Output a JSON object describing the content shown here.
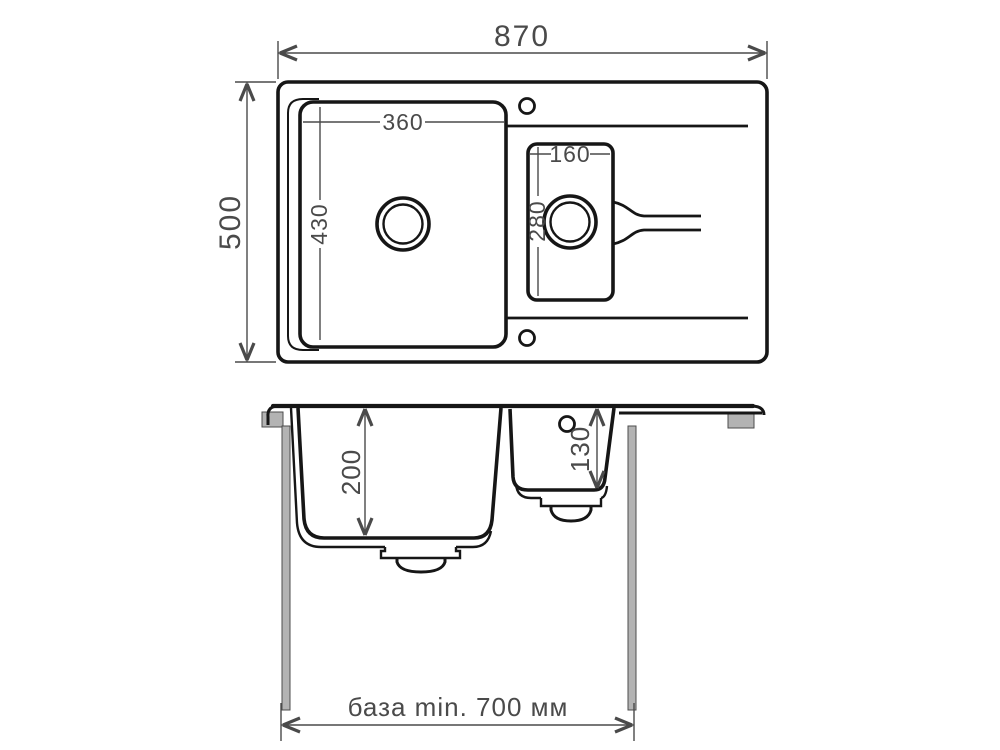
{
  "drawing": {
    "type": "kitchen-sink-dimension-drawing",
    "views": {
      "top_view": "plan view with two bowls and drainboard",
      "front_view": "front section with bowl depths and cabinet"
    }
  },
  "labels": {
    "overall_width": "870",
    "overall_depth": "500",
    "main_bowl_width": "360",
    "main_bowl_length": "430",
    "small_bowl_width": "160",
    "small_bowl_length": "280",
    "main_bowl_depth": "200",
    "small_bowl_depth": "130",
    "base_note": "база min. 700 мм"
  },
  "colors": {
    "drawing_line": "#161616",
    "dim_line": "#4a4a4a",
    "dim_text": "#4a4a4a",
    "hardware_gray": "#b3b3b3",
    "background": "#ffffff"
  }
}
